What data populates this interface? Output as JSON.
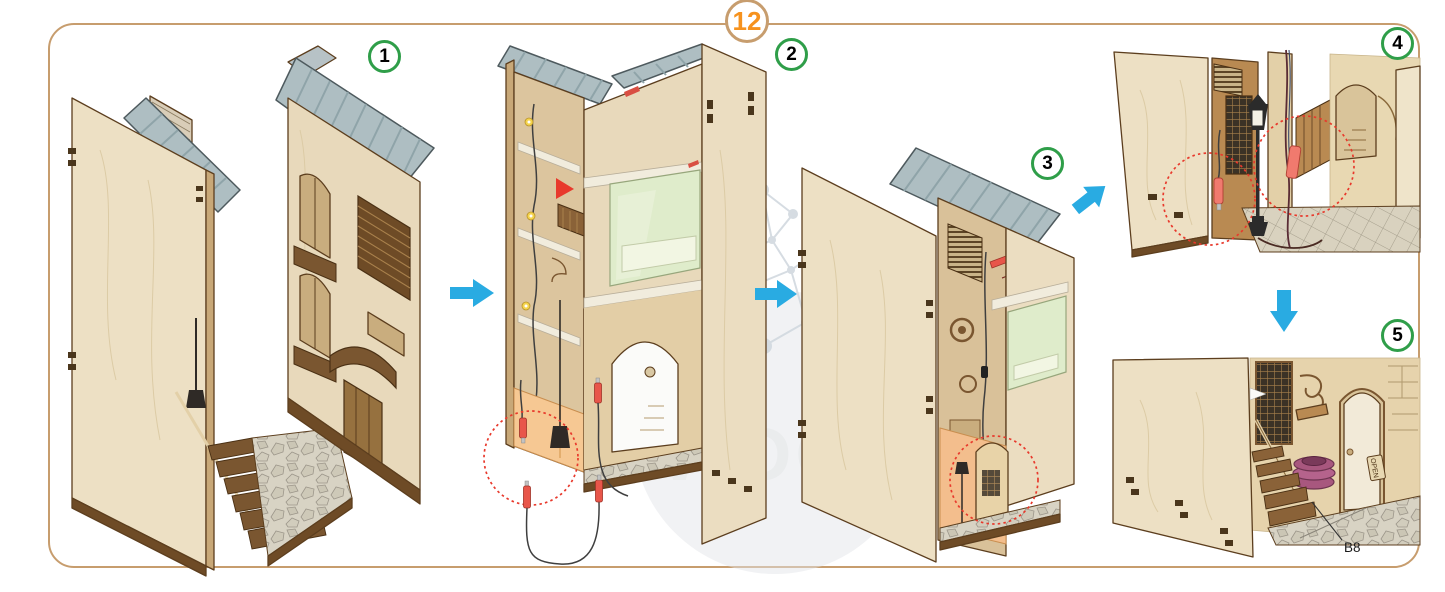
{
  "page": {
    "main_step_label": "12",
    "part_label": "B8",
    "door_sign_label": "OPEN",
    "watermark_text": "WOO"
  },
  "steps": [
    {
      "label": "1"
    },
    {
      "label": "2"
    },
    {
      "label": "3"
    },
    {
      "label": "4"
    },
    {
      "label": "5"
    }
  ],
  "icons": {
    "arrows": [
      "arrow-right",
      "arrow-right",
      "arrow-up-right",
      "arrow-down"
    ],
    "highlight_circle_count": 4,
    "street_lamp_count": 3
  },
  "colors": {
    "page_border": "#C79D6E",
    "main_step_number": "#F6921E",
    "step_badge_ring": "#2F9E49",
    "arrow_blue": "#29ABE2",
    "highlight_red": "#E8392C",
    "plywood_light": "#EDE0C4",
    "wood_dark": "#6E4B26",
    "roof_gray": "#AEBEC2",
    "glass_green": "#DFECCB",
    "glow_orange": "#F4C28E",
    "connector_red": "#E8564A",
    "barrel_purple": "#A8577E"
  }
}
